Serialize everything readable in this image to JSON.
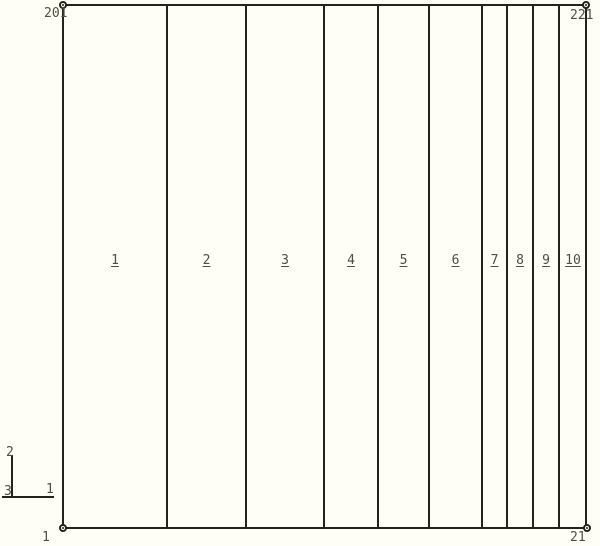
{
  "figure": {
    "background": "#fefdf6",
    "line_color": "#23231a",
    "label_color": "#4e4e42"
  },
  "areas": [
    {
      "label": "1"
    },
    {
      "label": "2"
    },
    {
      "label": "3"
    },
    {
      "label": "4"
    },
    {
      "label": "5"
    },
    {
      "label": "6"
    },
    {
      "label": "7"
    },
    {
      "label": "8"
    },
    {
      "label": "9"
    },
    {
      "label": "10"
    }
  ],
  "corner_nodes": {
    "top_left": "201",
    "top_right": "221",
    "bottom_left": "1",
    "bottom_right": "21"
  },
  "triad": {
    "axis_x": "1",
    "axis_y": "2",
    "axis_z": "3"
  }
}
